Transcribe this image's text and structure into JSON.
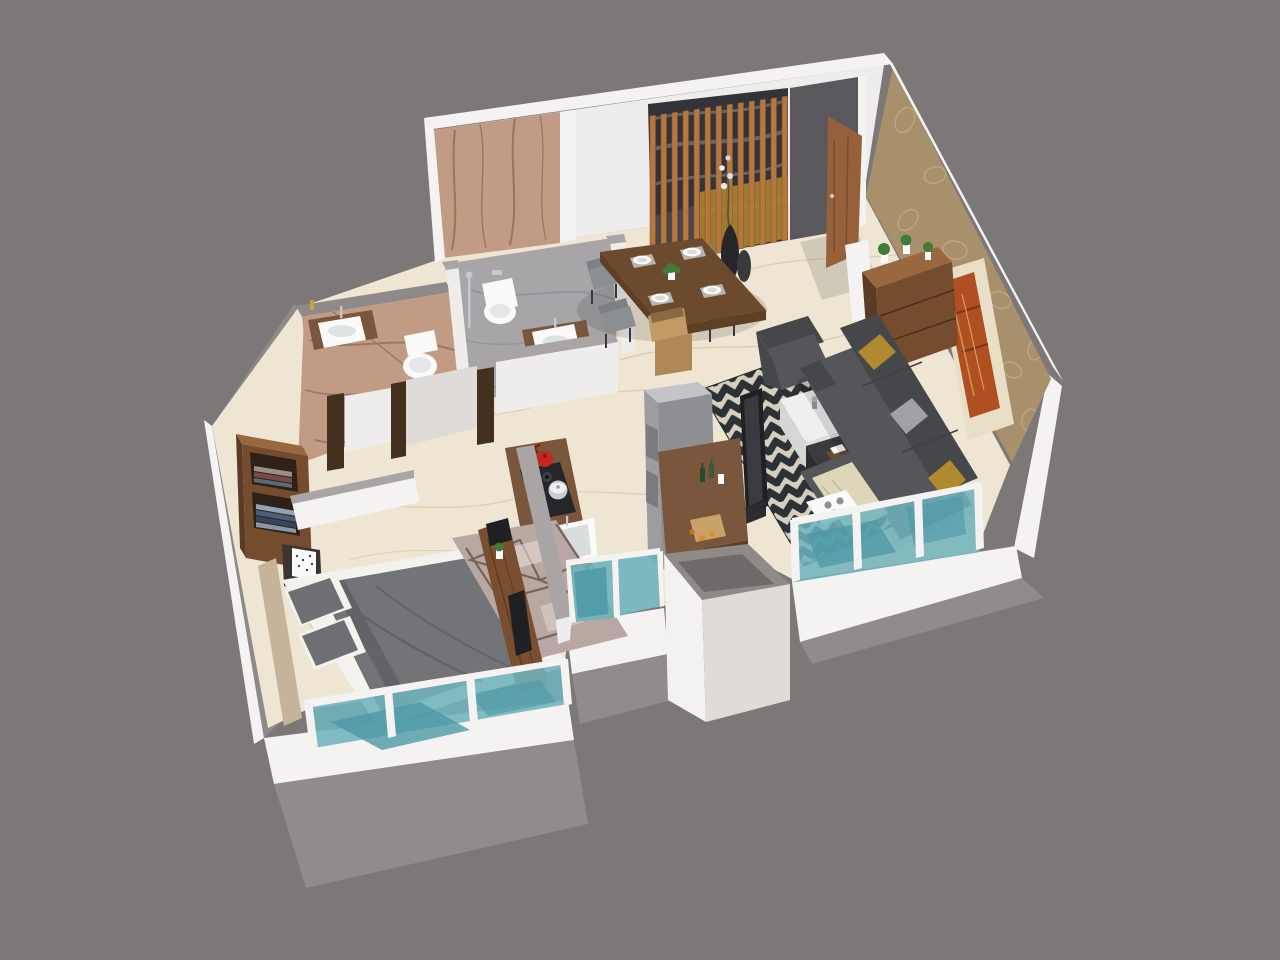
{
  "meta": {
    "view": "isometric-3d-floor-plan-render",
    "background": "#7d7878",
    "visible_text": []
  },
  "palette": {
    "bg": "#7d7878",
    "facadeGray": "#918c8c",
    "facadeGrayDark": "#847f7f",
    "bandWhite": "#f5f3f1",
    "wallCap": "#a9a5a4",
    "wallCapDark": "#8f8a8a",
    "wallFace": "#efedeb",
    "wallFaceShade": "#dedbd8",
    "floorCream": "#eee5d2",
    "floorVein": "#d5ba8e",
    "pinkMarble": "#c29b85",
    "pinkVein": "#7e5a49",
    "grayMarble": "#a7a5a8",
    "grayVein": "#868489",
    "wallpaper": "#a8906c",
    "wallpaperPattern": "#cdb68c",
    "woodDark": "#5b3b26",
    "woodMid": "#754c2e",
    "woodLight": "#99683f",
    "slatWood": "#b5763f",
    "doorWood": "#96613a",
    "doorFrameDark": "#43301f",
    "sofaGray": "#55565a",
    "sofaGrayDark": "#46474b",
    "cushionMustard": "#b08a2f",
    "cushionGray": "#9fa1a4",
    "rugCream": "#d6cfbf",
    "rugDark": "#2c3136",
    "glassTeal": "#6fb3bd",
    "glassTealDark": "#4e98a6",
    "ceramicWhite": "#fbfafa",
    "artOrange": "#b04f22",
    "artMat": "#e9dec6",
    "plantGreen": "#3e7c38",
    "counterBrown": "#7a573c",
    "counterEdge": "#5e4026",
    "applianceGray": "#9d9da1",
    "applianceLight": "#c4c4c8",
    "applianceDark": "#7c7c80",
    "kettleRed": "#c42722",
    "steelPot": "#c9ccd0",
    "bedDuvet": "#737477",
    "bedSheet": "#f4f2ef",
    "bedPillow": "#6e6f72",
    "bedroomRug": "#b9a8a2",
    "bedroomRugLine": "#6b5954",
    "hobBlack": "#26262a",
    "nicheDark": "#33343a",
    "nicheMustard": "#a8842f",
    "chairGray": "#8c8f92",
    "chairGrayDark": "#7e8184",
    "tableWood": "#6b4a2e",
    "black": "#1f2023",
    "chrome": "#c7cacd",
    "headboardWood": "#c5b49a"
  },
  "scene": {
    "rooms": [
      {
        "name": "foyer",
        "items": [
          "entrance-door",
          "wooden-slat-partition",
          "decor-vase-with-orchid",
          "accent-niche",
          "wood-stool"
        ]
      },
      {
        "name": "dining-area",
        "items": [
          "dining-table",
          "dining-chair",
          "dining-chair",
          "dining-chair",
          "dining-chair",
          "plates",
          "table-plant"
        ]
      },
      {
        "name": "living-room",
        "items": [
          "l-shaped-sofa",
          "mustard-cushions",
          "armchair",
          "chevron-rug",
          "coffee-table-white",
          "coffee-table-dark",
          "tv-panel",
          "wall-art",
          "console-cabinet",
          "plants",
          "glass-window-wall"
        ]
      },
      {
        "name": "kitchen",
        "items": [
          "hob-counter",
          "red-kettle",
          "steel-pot",
          "sink",
          "refrigerator",
          "breakfast-counter",
          "cutting-board",
          "bottles",
          "glass-windows"
        ]
      },
      {
        "name": "bedroom",
        "items": [
          "double-bed",
          "headboard",
          "pillows",
          "nightstand",
          "cube-lamp",
          "open-wardrobe",
          "desk-console",
          "geometric-rug",
          "glass-window-wall"
        ]
      },
      {
        "name": "bathroom-1",
        "items": [
          "vanity-washbasin",
          "toilet",
          "shower-set",
          "brown-marble-finish"
        ]
      },
      {
        "name": "bathroom-2",
        "items": [
          "vanity-washbasin",
          "wall-hung-toilet",
          "shower-set",
          "gray-marble-floor"
        ]
      },
      {
        "name": "exterior",
        "items": [
          "duct-shaft",
          "facade-band",
          "balcony-glass-railings"
        ]
      }
    ]
  }
}
